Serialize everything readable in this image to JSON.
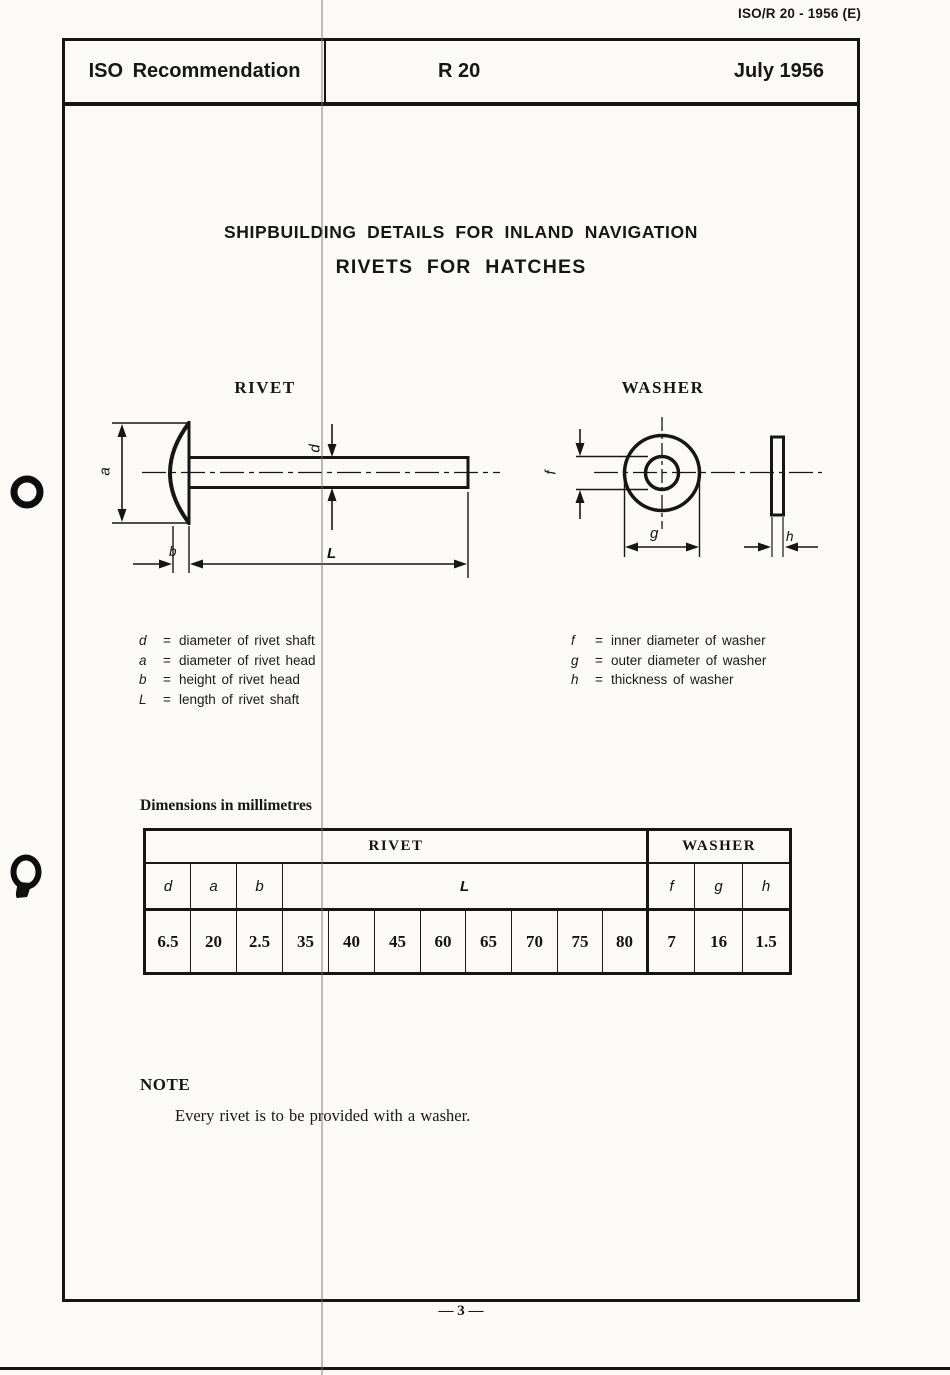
{
  "page": {
    "corner_ref": "ISO/R 20 - 1956 (E)",
    "page_number": "— 3 —"
  },
  "header": {
    "left": "ISO Recommendation",
    "center": "R 20",
    "right": "July 1956"
  },
  "titles": {
    "line1": "SHIPBUILDING DETAILS FOR INLAND NAVIGATION",
    "line2": "RIVETS FOR HATCHES"
  },
  "drawings": {
    "rivet": {
      "title": "RIVET",
      "labels": {
        "a": "a",
        "b": "b",
        "d": "d",
        "L": "L"
      }
    },
    "washer": {
      "title": "WASHER",
      "labels": {
        "f": "f",
        "g": "g",
        "h": "h"
      }
    }
  },
  "legend": {
    "equals": "=",
    "rivet": [
      {
        "symbol": "d",
        "desc": "diameter of rivet shaft"
      },
      {
        "symbol": "a",
        "desc": "diameter of rivet head"
      },
      {
        "symbol": "b",
        "desc": "height of rivet head"
      },
      {
        "symbol": "L",
        "desc": "length of rivet shaft"
      }
    ],
    "washer": [
      {
        "symbol": "f",
        "desc": "inner diameter of washer"
      },
      {
        "symbol": "g",
        "desc": "outer diameter of washer"
      },
      {
        "symbol": "h",
        "desc": "thickness of washer"
      }
    ]
  },
  "table": {
    "caption": "Dimensions in millimetres",
    "sections": {
      "rivet": "RIVET",
      "washer": "WASHER"
    },
    "col_headers": {
      "d": "d",
      "a": "a",
      "b": "b",
      "L": "L",
      "f": "f",
      "g": "g",
      "h": "h"
    },
    "values": [
      "6.5",
      "20",
      "2.5",
      "35",
      "40",
      "45",
      "60",
      "65",
      "70",
      "75",
      "80",
      "7",
      "16",
      "1.5"
    ]
  },
  "note": {
    "heading": "NOTE",
    "text": "Every rivet is to be provided with a washer."
  }
}
